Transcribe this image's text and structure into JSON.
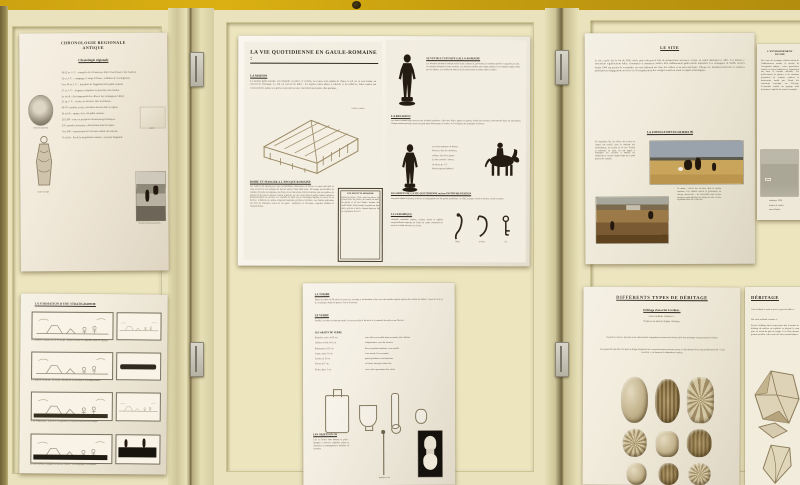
{
  "scene": {
    "description": "Photograph of cream hinged exhibition panels on a mustard wall holding eight archaeology posters"
  },
  "colors": {
    "wall_yellow": "#cda211",
    "panel_cream": "#e9e2bc",
    "poster_ivory": "#f2ecdd",
    "ink": "#3a332a",
    "bronze_silhouette": "#241c12"
  },
  "posters": {
    "chronology": {
      "title_line1": "CHRONOLOGIE REGIONALE",
      "title_line2": "ANTIQUE",
      "subtitle": "Chronologie régionale",
      "entries": [
        "58-52 av. J.-C. : conquête de la Gaule par Jules César (Guerre des Gaules).",
        "52 av. J.-C. : campagne et siège d'Alésia ; reddition de Vercingétorix.",
        "Vers 40 av. J.-C. : fondation de l'agglomération gallo-romaine.",
        "27 av. J.-C. : Auguste réorganise les provinces des Gaules.",
        "Ier siècle : développement des villes et des campagnes (villae).",
        "21 ap. J.-C. : révolte de Sacrovir chez les Eduens.",
        "69-70 : troubles civils ; incendies attestés dans la région.",
        "IIe siècle : apogée de la cité gallo-romaine.",
        "235-284 : crises et premières incursions germaniques.",
        "276 : grandes invasions ; destructions dans la région.",
        "Vers 300 : construction de l'enceinte réduite du castrum.",
        "Ve siècle : fin de la domination romaine ; royaume burgonde."
      ],
      "caption_coin": "monnaie gauloise",
      "caption_toga": "statue en toge",
      "caption_sketch": "relevé",
      "caption_photo": "vue des fouilles anciennes"
    },
    "daily_life": {
      "title": "LA VIE QUOTIDIENNE EN GAULE-ROMAINE :",
      "maison_h": "LA MAISON",
      "maison_p": "La maison gallo-romaine est construite en pierre et en bois. Les murs sont enduits de chaux, le sol est en terre battue ou couvert de mosaïque. Le toit est couvert de tuiles : les tegulae, tuiles plates à rebords, et les imbrices, tuiles rondes qui recouvrent les joints. Les pièces s'ouvrent sur une cour intérieure bordée d'un portique.",
      "house_caption": "toiture en tuiles",
      "boire_h": "BOIRE ET MANGER A L'EPOQUE ROMAINE",
      "boire_p": "Les Gaulois ont adopté peu à peu les habitudes alimentaires de Rome. Le repas principal, la cena, est pris le soir, allongé sur des lits autour d'une table basse. On mange des bouillies de céréales, du pain, des légumes, des fruits, de la charcuterie dont les Gaulois sont des maîtres, du poisson et des sauces relevées comme le garum. Le vin, coupé d'eau et parfois miellé, remplace progressivement la cervoise. La vaisselle de table est en céramique sigillée, en verre ou en bronze ; la batterie de cuisine comprend marmites, poêlons et mortiers. Les fouilles régionales ont livré de nombreux restes de ces repas : amphores, os découpés, coquilles d'huîtres et vaisselle brisée.",
      "recette_h": "UNE RECETTE ROMAINE",
      "recette_p": "Patina de poires : faire cuire les poires, les écraser avec du poivre, du cumin, du miel, du garum et un peu d'huile. Ajouter des oeufs battus, faire prendre la patina au four doux, poivrer et servir. D'après Apicius, De re coquinaria, livre IV.",
      "vetir_h": "SE VETIR A L'EPOQUE GALLO-ROMAINE",
      "vetir_p": "Les hommes portent la tunique serrée d'une ceinture et, par-dessus, le manteau gaulois à capuchon, la saie ; les notables adoptent la toge romaine. Les femmes revêtent une longue tunique et un manteau drapé retenu par des fibules. Les étoffes de laine et de lin sont tissées et teintes dans la région.",
      "religion_h": "LA RELIGION",
      "religion_p": "Les dieux romains sont associés aux divinités gauloises : Mercure, Mars, Jupiter ou Epona, déesse des chevaux, sont honorés dans les sanctuaires. Chaque maison possède aussi son petit autel domestique, le laraire, où l'on dépose des statuettes de bronze.",
      "figure_captions": [
        "Les deux statuettes de bronze :",
        "Mercure, dieu du commerce,",
        "et Mars, dieu de la guerre.",
        "Le dieu cavalier : bronze,",
        "IIe siècle ap. J.-C.",
        "Musée régional (photos)"
      ],
      "objets_h": "LES OBJETS DE LA VIE QUOTIDIENNE ou leur INSTRUMENTATION",
      "objets_p": "Les petits objets de bronze et de fer accompagnent tous les gestes quotidiens : se vêtir, se parer, ouvrir et fermer, coudre ou peser.",
      "ceramique_h": "LA CERAMIQUE",
      "ceramique_p": "Vaisselle commune sombre, cruches claires et sigillée rouge brillante importée de Gaule du centre composent le service de table retrouvé sur le site.",
      "object_captions": [
        "fibule",
        "crochet",
        "clé"
      ]
    },
    "excavation": {
      "title": "LE SITE",
      "intro_p": "Le site, repéré dès la fin du XIXe siècle puis redécouvert lors de prospections aériennes, occupe un replat dominant la vallée. Les labours y ramenaient régulièrement tuiles, céramiques et monnaies, indices d'un établissement gallo-romain important. Les campagnes de fouille menées depuis 1994 ont permis de reconnaître un vaste bâtiment sur cour, des celliers et un petit sanctuaire. Chaque été, fouilleurs bénévoles et scolaires participent au dégagement, au relevé et à l'enregistrement des vestiges avant leur étude au dépôt archéologique.",
      "section_h": "LA FOUILLE DES ECOLIERS 96",
      "col1_p": "En septembre 96, les élèves des écoles du canton ont fouillé, sous la conduite des archéologues, un secteur de la cour. Truelle et balayette en main, ils ont appris à distinguer les couches, à tamiser les sédiments et à situer chaque objet sur le plan général du chantier.",
      "caption_p": "Ci-contre : relevé des niveaux dans la grande tranchée. Les enfants notent la profondeur de chaque découverte ; les trouvailles sont lavées, marquées puis déposées au musée de site, où une exposition leur est consacrée.",
      "photo1_name": "les élèves au tamisage dans le champ",
      "photo2_name": "la grande tranchée en cours de fouille"
    },
    "right_sheet": {
      "h_line1": "L'ENVIRONNEMENT",
      "h_line2": "DU SITE",
      "p1": "Une carte des sondages réalisés autour de l'établissement montre la densité de l'occupation antique : voies, parcellaires fossiles et fermes indigènes se répartissent sur toute la terrasse alluviale. Les prélèvements de graines et de charbons permettent de restituer cultures et boisements, tandis que l'étude des ossements renseigne sur l'élevage. L'ensemble restitue un paysage rural densément exploité dès avant la conquête.",
      "map_label": "plan",
      "legend": [
        "sondages 1996",
        "limites de fouille",
        "zone détruite"
      ]
    },
    "stratigraphy": {
      "title": "LA FORMATION D'UNE STRATIGRAPHIE",
      "captions": [
        "1. L'homme s'installe sur un sol vierge : premier niveau d'occupation, foyers et cabanes.",
        "2. L'habitat est détruit ; les ruines s'effondrent, se nivellent et sont abandonnées.",
        "3. Le temps passe : la terre et la végétation recouvrent lentement les vestiges.",
        "4. Une nouvelle occupation scelle les couches : la stratigraphie s'est formée."
      ]
    },
    "glass": {
      "tombe_h": "LA TOMBE",
      "tombe_p": "Datée du milieu du IIe siècle de notre ère, la tombe à incinération a livré un riche mobilier déposé auprès des cendres du défunt : vases de verre et de céramique, objets de parure, d'os et de bronze.",
      "verre_h": "LE VERRE",
      "verre_p": "Soufflé à la volée ou dans un moule, le verre sert dès le Ier siècle à la vaisselle de table et aux flacons.",
      "list_h": "LES OBJETS DE VERRE",
      "items": [
        {
          "n": "Bouteille carrée, ht 18 cm",
          "d": "verre bleu-vert soufflé dans un moule, anse rubanée"
        },
        {
          "n": "Gobelet ovoïde, ht 9 cm",
          "d": "à dépressions, verre fin incolore"
        },
        {
          "n": "Balsamaire, ht 12 cm",
          "d": "flacon à parfum tubulaire, verre soufflé"
        },
        {
          "n": "Coupe, diam. 10 cm",
          "d": "verre moulé, lèvre arrondie"
        },
        {
          "n": "Cruche, ht 15 cm",
          "d": "panse globulaire, fond annulaire"
        },
        {
          "n": "Flacon, ht 7 cm",
          "d": "col étroit, fond plat, bulle d'air"
        },
        {
          "n": "Perles, diam. 1 cm",
          "d": "verre coloré provenant d'un collier"
        }
      ],
      "os_h": "LES OBJETS EN OS",
      "os_p": "L'os et l'ivoire sont tournés et polis : épingles à cheveux, aiguilles, jetons et charnières accompagnent le mobilier de la tombe.",
      "pin_caption": "épingle en os",
      "photo_caption": "fuseau tourné"
    },
    "debitage_levallois": {
      "title": "DIFFÉRENTS TYPES DE DÉBITAGE",
      "sub": "Débitage d'un éclat Levallois :",
      "line1": "Cette méthode consiste à :",
      "line2": "Préparer un plan de frappe circulaire",
      "p1": "A partir de celui-ci, procéder à des enlèvements centripètes tout autour du nucléus afin d'en aménager soigneusement la surface.",
      "p2": "La préparation spéciale d'un plan de frappe dégageant une convexité permet, par percussion, le détachement d'un éclat prédéterminé dit « éclat Levallois », de forme et de dimensions voulues."
    },
    "debitage_right": {
      "title": "DÉBITAGE",
      "sub": "Cette méthode a suivi de près le geste du tailleur :",
      "line1": "Une autre méthode consiste à :",
      "p1": "Selon le débitage direct au percuteur dur, la surface de débitage du nucléus est exploitée en plaçant le coup juste en retrait du plan de frappe. Les éclats obtenus portent un bulbe et des ondes de choc caractéristiques."
    }
  }
}
